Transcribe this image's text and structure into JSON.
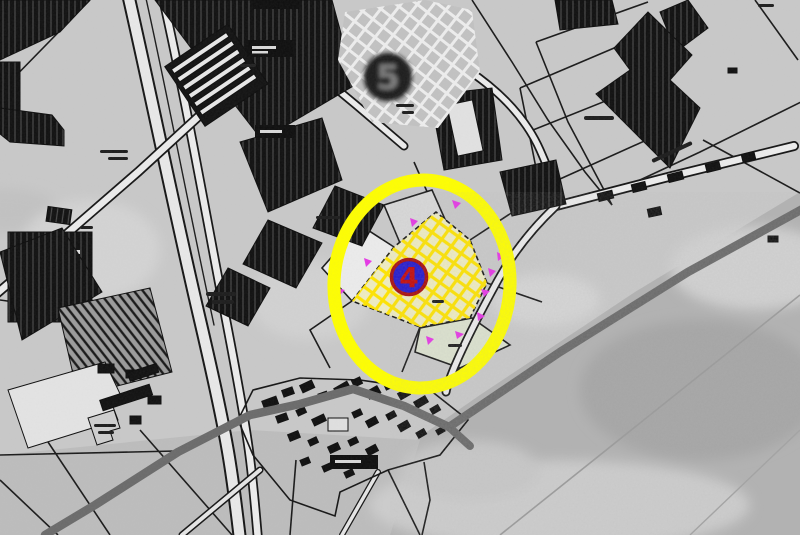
{
  "map": {
    "description": "grayscale cadastral plan over aerial photo with highlighted site",
    "markers": [
      {
        "id": "site-5",
        "label": "5",
        "fill": "#1f1f1f",
        "ring_color": "#0c0c0c",
        "text_color": "#7b7b7b"
      },
      {
        "id": "site-4",
        "label": "4",
        "fill": "#2318cd",
        "ring_color": "#a80b0b",
        "text_color": "#c40808"
      }
    ],
    "highlight": {
      "shape": "ellipse",
      "stroke": "#ffff00",
      "selection_hatch_color": "#ffe400",
      "survey_point_color": "#e637e6"
    },
    "palette": {
      "map_paper": "#cbcbcb",
      "photo_gray": "#b3b3b3",
      "building_dark": "#101010",
      "road_white": "#f2f2f2",
      "heavy_road_gray": "#6a6a6a",
      "parcel_green": "#dce2cf",
      "zone5_hatch": "#ededed"
    }
  }
}
